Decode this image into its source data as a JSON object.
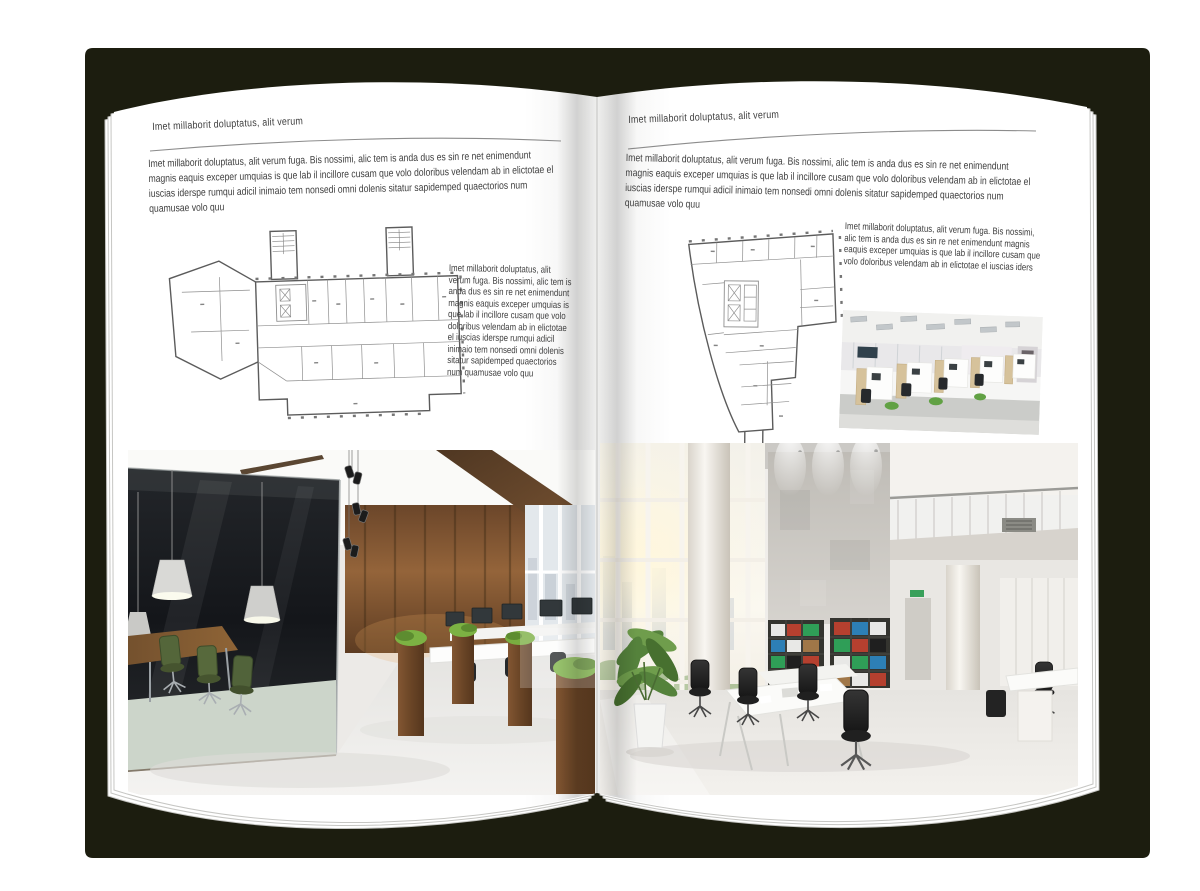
{
  "book": {
    "cover_color": "#1c1d0f",
    "page_color": "#ffffff"
  },
  "left_page": {
    "header": "Imet millaborit doluptatus, alit verum",
    "intro": "Imet millaborit doluptatus, alit verum fuga. Bis nossimi, alic tem is anda dus es sin re net enimendunt magnis eaquis exceper umquias is que lab il incillore cusam que volo doloribus velendam ab in elictotae el iuscias iderspe rumqui adicil inimaio tem nonsedi omni dolenis sitatur sapidemped quaectorios num quamusae volo quu",
    "side_text": "Imet millaborit doluptatus, alit verum fuga. Bis nossimi, alic tem is anda dus es sin re net enimendunt magnis eaquis exceper umquias is que lab il incillore cusam que volo doloribus velendam ab in elictotae el iuscias iderspe rumqui adicil inimaio tem nonsedi omni dolenis sitatur sapidemped quaectorios num quamusae volo quu",
    "floor_plan_alt": "Grayscale architectural floor plan of an elongated building with two stair towers and an angled west wing",
    "photo_alt": "Office interior with dark glass-walled meeting room, green chairs, pendant lamps, wooden wall and workstations with planters"
  },
  "right_page": {
    "header": "Imet millaborit doluptatus, alit verum",
    "intro": "Imet millaborit doluptatus, alit verum fuga. Bis nossimi, alic tem is anda dus es sin re net enimendunt magnis eaquis exceper umquias is que lab il incillore cusam que volo doloribus velendam ab in elictotae el iuscias iderspe rumqui adicil inimaio tem nonsedi omni dolenis sitatur sapidemped quaectorios num quamusae volo quu",
    "side_text": "Imet millaborit doluptatus, alit verum fuga. Bis nossimi, alic tem is anda dus es sin re net enimendunt magnis eaquis exceper umquias is que lab il incillore cusam que volo doloribus velendam ab in elictotae el iuscias iders",
    "floor_plan_alt": "Grayscale architectural floor plan of an irregular wedge-shaped building with elevator core and stair stem",
    "small_photo_alt": "Open-plan office with light wood cubicle partitions, black chairs and ceiling light panels",
    "photo_alt": "Bright double-height office atrium with glazed wall, concrete feature wall, binder bookshelves, white desks and black chairs"
  }
}
